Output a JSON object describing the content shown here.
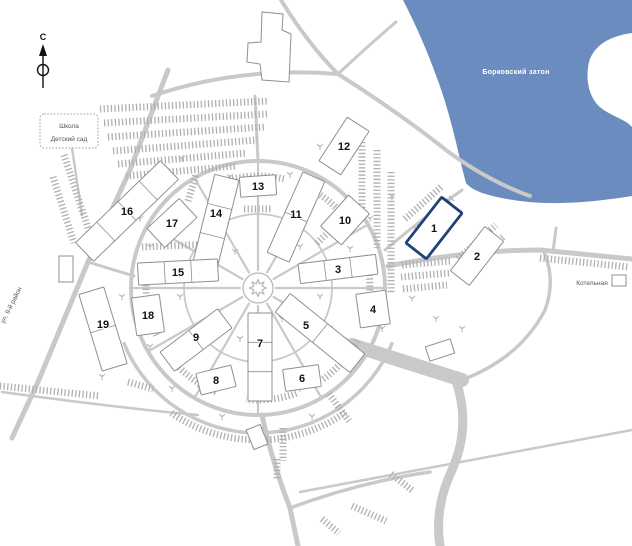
{
  "map": {
    "compass": "С",
    "school": {
      "line1": "Школа",
      "line2": "Детский сад"
    },
    "water": "Борковский затон",
    "boiler": "Котельная",
    "street": "ул. 9-й район",
    "buildings": [
      {
        "number": "1",
        "highlighted": true
      },
      {
        "number": "2",
        "highlighted": false
      },
      {
        "number": "3",
        "highlighted": false
      },
      {
        "number": "4",
        "highlighted": false
      },
      {
        "number": "5",
        "highlighted": false
      },
      {
        "number": "6",
        "highlighted": false
      },
      {
        "number": "7",
        "highlighted": false
      },
      {
        "number": "8",
        "highlighted": false
      },
      {
        "number": "9",
        "highlighted": false
      },
      {
        "number": "10",
        "highlighted": false
      },
      {
        "number": "11",
        "highlighted": false
      },
      {
        "number": "12",
        "highlighted": false
      },
      {
        "number": "13",
        "highlighted": false
      },
      {
        "number": "14",
        "highlighted": false
      },
      {
        "number": "15",
        "highlighted": false
      },
      {
        "number": "16",
        "highlighted": false
      },
      {
        "number": "17",
        "highlighted": false
      },
      {
        "number": "18",
        "highlighted": false
      },
      {
        "number": "19",
        "highlighted": false
      }
    ]
  },
  "colors": {
    "water": "#6b8cbe",
    "road": "#c9c9c9",
    "hatch": "#b0b0b0",
    "outline": "#8f8f8f",
    "highlight": "#1f4178"
  }
}
